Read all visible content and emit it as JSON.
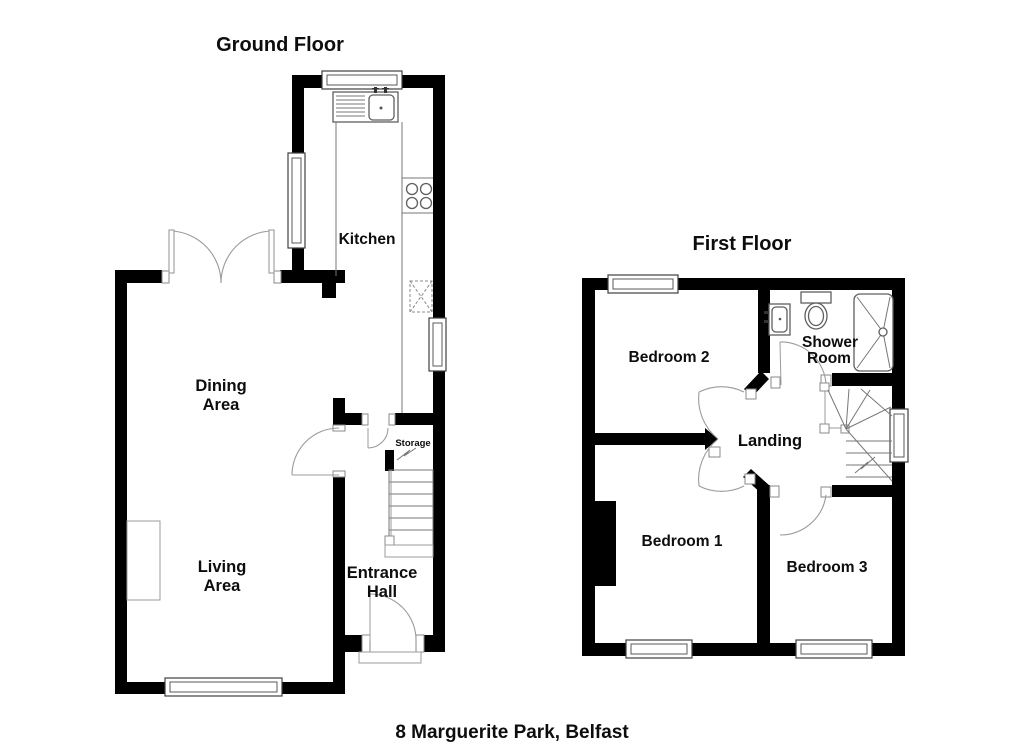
{
  "ground_floor": {
    "title": "Ground Floor",
    "labels": {
      "kitchen": "Kitchen",
      "dining_1": "Dining",
      "dining_2": "Area",
      "living_1": "Living",
      "living_2": "Area",
      "entrance_1": "Entrance",
      "entrance_2": "Hall",
      "storage": "Storage"
    }
  },
  "first_floor": {
    "title": "First Floor",
    "labels": {
      "bedroom2": "Bedroom 2",
      "shower_1": "Shower",
      "shower_2": "Room",
      "landing": "Landing",
      "bedroom1": "Bedroom 1",
      "bedroom3": "Bedroom 3"
    }
  },
  "footer": {
    "address": "8 Marguerite Park, Belfast"
  },
  "colors": {
    "wall": "#000000",
    "background": "#ffffff",
    "linework": "#8a8a8a",
    "text": "#0d0d0d"
  }
}
